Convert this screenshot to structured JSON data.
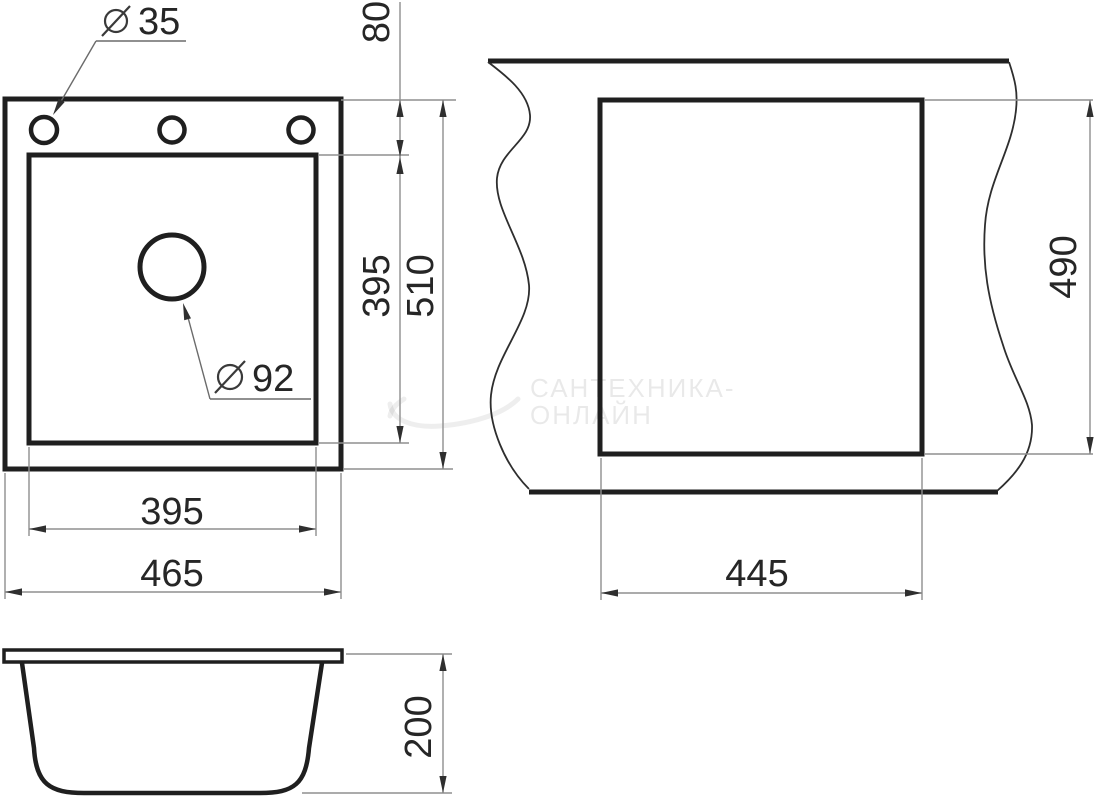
{
  "colors": {
    "background": "#ffffff",
    "outline": "#1f1f1f",
    "dimension_lines": "#8f8f8f",
    "dimension_text": "#262626",
    "watermark": "rgba(0,0,0,0.08)"
  },
  "symbols": {
    "diameter": "⌀"
  },
  "plan_view": {
    "faucet_hole_diameter": "35",
    "drain_diameter": "92",
    "rim_to_bowl_offset": "80",
    "bowl_depth": "395",
    "overall_depth": "510",
    "bowl_width": "395",
    "overall_width": "465"
  },
  "cutout_view": {
    "cutout_depth": "490",
    "cutout_width": "445"
  },
  "side_view": {
    "overall_height": "200"
  },
  "watermark": {
    "line1": "САНТЕХНИКА-",
    "line2": "ОНЛАЙН"
  }
}
